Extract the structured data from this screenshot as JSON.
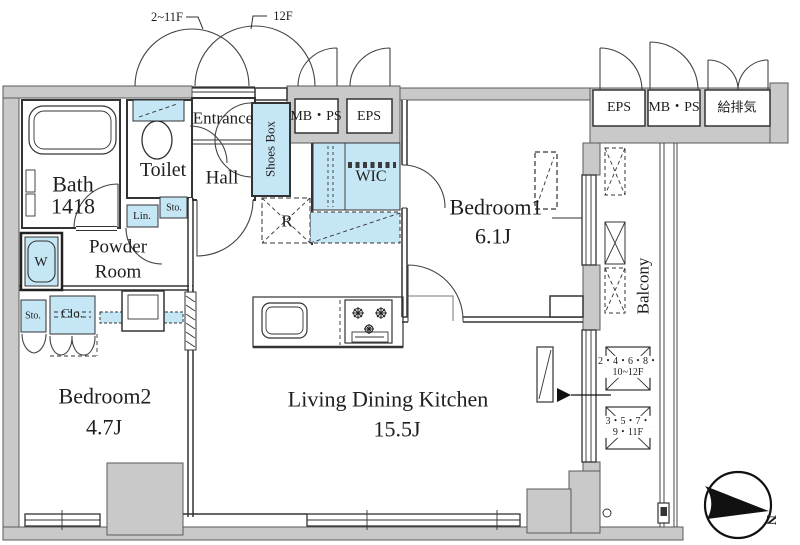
{
  "labels": {
    "floor_left": "2~11F",
    "floor_right": "12F",
    "entrance": "Entrance",
    "shoes_box": "Shoes Box",
    "toilet": "Toilet",
    "bath_name": "Bath",
    "bath_size": "1418",
    "hall": "Hall",
    "powder_line1": "Powder",
    "powder_line2": "Room",
    "wic": "WIC",
    "fridge": "R",
    "linen": "Lin.",
    "sto_hall": "Sto.",
    "washer": "W",
    "sto_bedroom2": "Sto.",
    "closet": "Clo.",
    "bedroom1_name": "Bedroom1",
    "bedroom1_size": "6.1J",
    "bedroom2_name": "Bedroom2",
    "bedroom2_size": "4.7J",
    "ldk_name": "Living Dining Kitchen",
    "ldk_size": "15.5J",
    "balcony": "Balcony",
    "mbps_left": "MB・PS",
    "eps_left": "EPS",
    "eps_right": "EPS",
    "mbps_right": "MB・PS",
    "kyuhaiki": "給排気",
    "ac_upper_line1": "2・4・6・8・",
    "ac_upper_line2": "10~12F",
    "ac_lower_line1": "3・5・7・",
    "ac_lower_line2": "9・11F",
    "north": "N"
  },
  "colors": {
    "fixture_blue": "#c5e6f4",
    "wall_gray": "#c9c9c9",
    "line": "#333333"
  }
}
